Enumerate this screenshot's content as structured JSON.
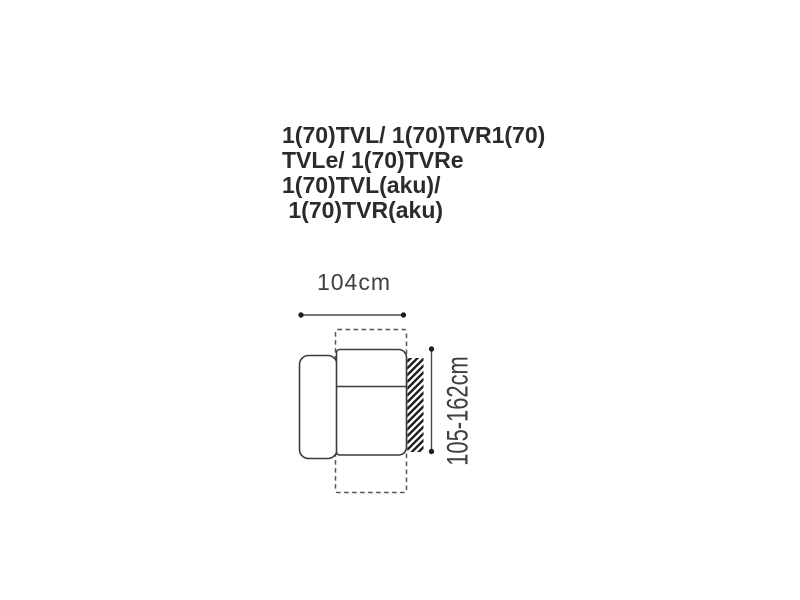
{
  "page": {
    "background_color": "#ffffff"
  },
  "title": {
    "color": "#2b2b2b",
    "lines": [
      "1(70)TVL/ 1(70)TVR1(70)",
      "TVLe/ 1(70)TVRe",
      "1(70)TVL(aku)/",
      " 1(70)TVR(aku)"
    ]
  },
  "diagram": {
    "width_dimension_label": "104cm",
    "height_dimension_label": "105-162cm",
    "colors": {
      "outline": "#3b3b3b",
      "dashed_outline": "#555555",
      "dimension_line": "#4a4a4a",
      "dimension_dot": "#1f1f1f",
      "hatch": "#1e1e1e",
      "label_text": "#3f3f3f"
    }
  }
}
